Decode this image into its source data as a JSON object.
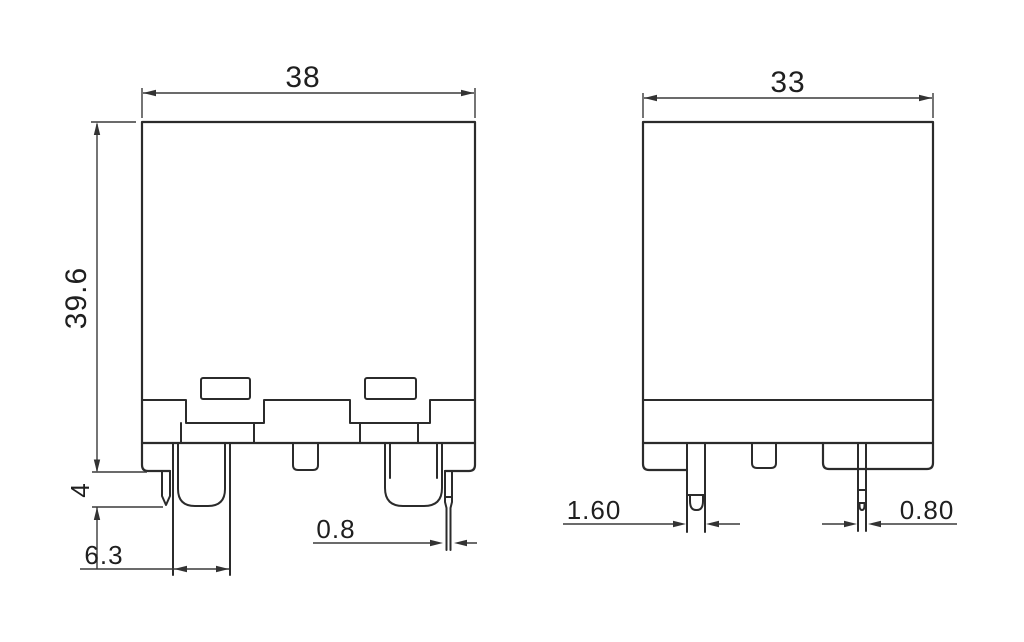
{
  "drawing": {
    "front_view": {
      "width_mm": "38",
      "height_mm": "39.6",
      "pin_standoff_mm": "4",
      "blade_terminal_width_mm": "6.3",
      "pin_thickness_mm": "0.8"
    },
    "side_view": {
      "width_mm": "33",
      "coil_pin_width_mm": "1.60",
      "pin_thickness_mm": "0.80"
    },
    "colors": {
      "line": "#2b2b2b",
      "dimension": "#3a3a3a",
      "background": "#ffffff"
    }
  }
}
